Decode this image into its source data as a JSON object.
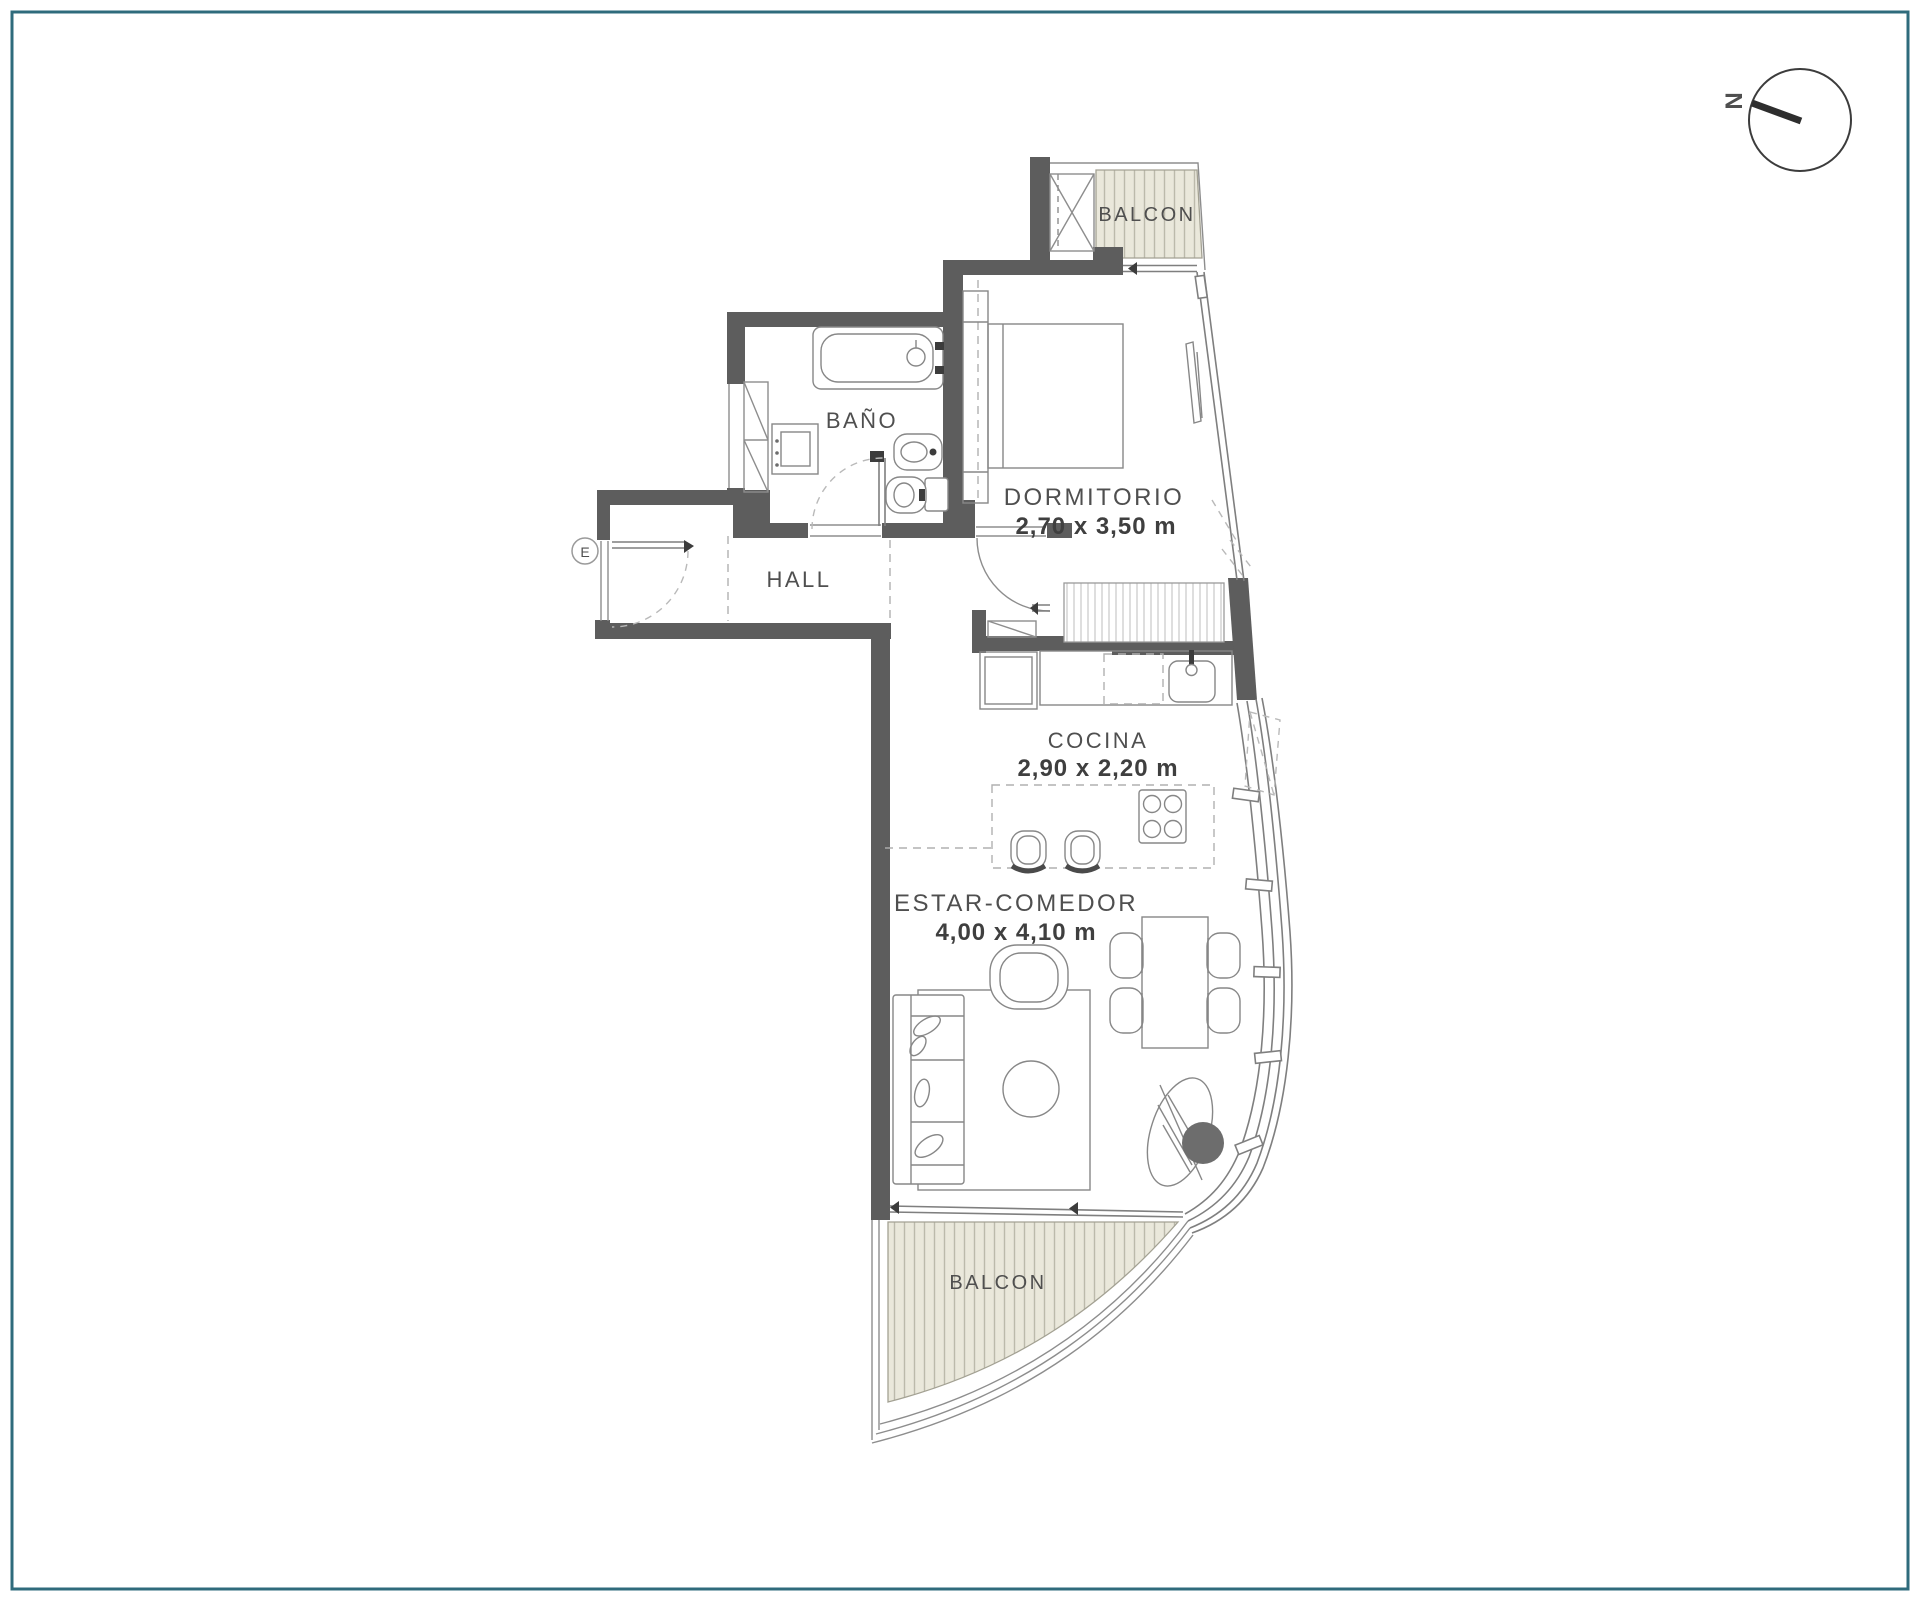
{
  "labels": {
    "balcony_top": "BALCON",
    "bedroom_name": "DORMITORIO",
    "bedroom_dims": "2,70 x 3,50 m",
    "bathroom_name": "BAÑO",
    "hall_name": "HALL",
    "kitchen_name": "COCINA",
    "kitchen_dims": "2,90 x 2,20 m",
    "living_name": "ESTAR-COMEDOR",
    "living_dims": "4,00 x 4,10 m",
    "balcony_bottom": "BALCON",
    "entrance": "E",
    "compass_north": "N"
  },
  "colors": {
    "wall": "#5d5d5d",
    "deck_fill": "#eae8db",
    "deck_stripe": "#bcbaab",
    "deck_outline": "#a3a193",
    "line": "#8d8d8d",
    "text": "#4f4f4f",
    "border": "#2f6b7c",
    "dark_accent": "#6d6d6d"
  }
}
